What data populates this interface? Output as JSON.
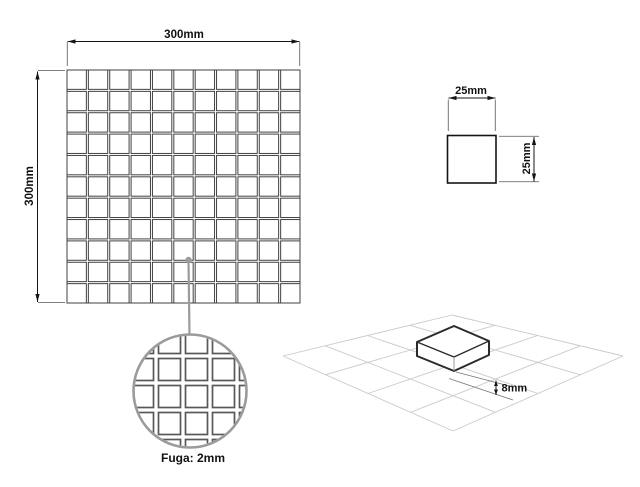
{
  "drawing_title": "mosaic-tile-specification",
  "sheet_view": {
    "width_label": "300mm",
    "height_label": "300mm",
    "rows": 11,
    "cols": 11
  },
  "tile_view": {
    "width_label": "25mm",
    "height_label": "25mm"
  },
  "detail_view": {
    "grout_label": "Fuga: 2mm"
  },
  "iso_view": {
    "thickness_label": "8mm",
    "grid_cells": 4
  },
  "colors": {
    "line_dark": "#141414",
    "sheet_grid_line": "#424242",
    "extension_line": "#555555",
    "detail_gray": "#9b9b9b",
    "detail_grid_line": "#585858",
    "iso_grid_line": "#cacaca",
    "box_edge": "#2b2b2b",
    "background": "#ffffff"
  }
}
